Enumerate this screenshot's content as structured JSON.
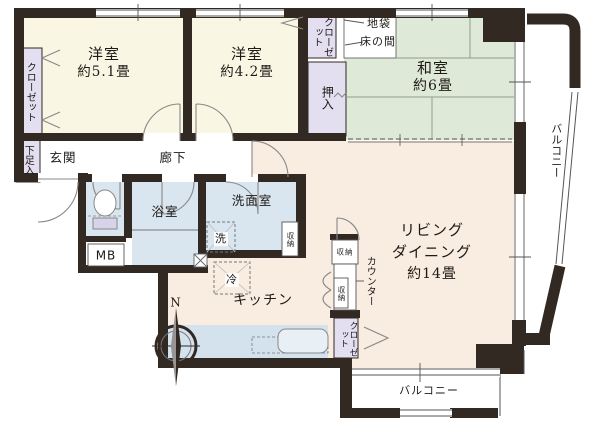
{
  "rooms": {
    "bedroom1": {
      "name": "洋室",
      "size": "約5.1畳"
    },
    "bedroom2": {
      "name": "洋室",
      "size": "約4.2畳"
    },
    "japanese_room": {
      "name": "和室",
      "size": "約6畳"
    },
    "living_dining": {
      "line1": "リビング",
      "line2": "ダイニング",
      "size": "約14畳"
    },
    "kitchen": {
      "name": "キッチン"
    },
    "corridor": {
      "name": "廊下"
    },
    "entrance": {
      "name": "玄関"
    },
    "bathroom": {
      "name": "浴室"
    },
    "washroom": {
      "name": "洗面室"
    }
  },
  "storage": {
    "closet": "クローゼット",
    "oshiire": "押入",
    "shoe_box": "下足入",
    "shuunou": "収納",
    "jibukuro": "地袋",
    "tokonoma": "床の間",
    "meter_box": "MB"
  },
  "fixtures": {
    "washer": "洗",
    "fridge": "冷",
    "counter": "カウンター"
  },
  "outdoor": {
    "balcony": "バルコニー"
  },
  "compass": {
    "north": "N"
  },
  "colors": {
    "wall": "#322923",
    "western_room": "#faf6e4",
    "japanese_room": "#dfe9d8",
    "ldk": "#f9ece1",
    "wet_area": "#d9e5ef",
    "closet": "#e3def0"
  }
}
